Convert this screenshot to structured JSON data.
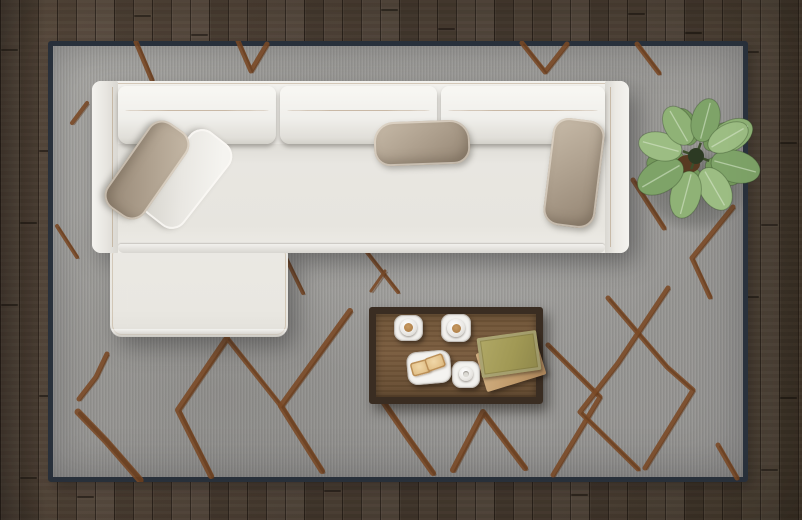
{
  "scene": {
    "description": "Top-down view of a modern living room: a white L-shaped sectional sofa with taupe and white pillows sits on a gray rug with a brown hand-drawn diamond lattice pattern; a dark wooden coffee table holds two coffee cups, a plate with toast, a small white cup and two stacked books; a leafy green potted plant stands at the top right; dark brown vertical wood planks form the floor.",
    "objects": {
      "floor": "dark wood plank floor",
      "rug": "gray area rug with brown diamond lattice pattern",
      "rug_pattern": "brown hand-drawn diamond lattice",
      "sofa": "white L-shaped sectional sofa",
      "left_arm": "sofa left armrest",
      "right_arm": "sofa right armrest",
      "back_cushion": "sofa back cushion",
      "seat": "sofa seat",
      "chaise": "chaise lounge extension",
      "pillow_taupe_corner": "taupe accent pillow (corner)",
      "pillow_white_corner": "white accent pillow (corner)",
      "pillow_taupe_center": "taupe accent pillow (center)",
      "pillow_taupe_right": "taupe accent pillow (right)",
      "table": "dark wood coffee table",
      "coffee_cup_1": "coffee cup on square saucer",
      "coffee_cup_2": "coffee cup on square saucer",
      "espresso_cup": "small white cup on square saucer",
      "toast_plate": "square plate with two toast slices",
      "book_tan": "tan book",
      "book_green": "olive green book",
      "plant": "potted green plant (top view)",
      "plant_shadow": "plant shadow on rug"
    }
  },
  "palette": {
    "floor_base": "#4c3f34",
    "floor_light": "#5b4c3e",
    "floor_dark": "#41362a",
    "rug_field": "#9e9d9a",
    "rug_border": "#2a323d",
    "rug_pattern": "#7b4a27",
    "rug_pattern_dark": "#5e3618",
    "sofa_white": "#e9e7e2",
    "pillow_taupe": "#b0a290",
    "table_wood": "#6f5437",
    "table_frame": "#3a2d22",
    "coffee": "#c79a63",
    "toast": "#e3c28b",
    "book_green": "#a19955",
    "book_tan": "#c09a6a",
    "soil": "#583a22",
    "leaf_vein": "#dcead0",
    "plant_center": "#2c3a23"
  },
  "rug": {
    "pattern_strokes": [
      {
        "w": 5,
        "pts": [
          [
            88,
            1
          ],
          [
            104,
            39
          ]
        ]
      },
      {
        "w": 5,
        "pts": [
          [
            190,
            0
          ],
          [
            203,
            30
          ],
          [
            219,
            3
          ]
        ]
      },
      {
        "w": 5,
        "pts": [
          [
            474,
            2
          ],
          [
            497,
            31
          ],
          [
            519,
            3
          ]
        ]
      },
      {
        "w": 5,
        "pts": [
          [
            589,
            3
          ],
          [
            611,
            32
          ]
        ]
      },
      {
        "w": 4,
        "pts": [
          [
            39,
            62
          ],
          [
            24,
            82
          ]
        ]
      },
      {
        "w": 4,
        "pts": [
          [
            9,
            185
          ],
          [
            29,
            216
          ]
        ]
      },
      {
        "w": 5,
        "pts": [
          [
            59,
            313
          ],
          [
            48,
            336
          ],
          [
            31,
            358
          ]
        ]
      },
      {
        "w": 7,
        "pts": [
          [
            30,
            371
          ],
          [
            58,
            400
          ],
          [
            92,
            439
          ]
        ]
      },
      {
        "w": 6,
        "pts": [
          [
            179,
            297
          ],
          [
            130,
            369
          ],
          [
            163,
            435
          ]
        ]
      },
      {
        "w": 5,
        "pts": [
          [
            179,
            297
          ],
          [
            233,
            365
          ]
        ]
      },
      {
        "w": 6,
        "pts": [
          [
            302,
            270
          ],
          [
            233,
            365
          ],
          [
            274,
            430
          ]
        ]
      },
      {
        "w": 4,
        "pts": [
          [
            237,
            215
          ],
          [
            255,
            252
          ]
        ]
      },
      {
        "w": 4,
        "pts": [
          [
            318,
            210
          ],
          [
            350,
            251
          ]
        ]
      },
      {
        "w": 3,
        "pts": [
          [
            337,
            230
          ],
          [
            323,
            250
          ]
        ]
      },
      {
        "w": 6,
        "pts": [
          [
            334,
            359
          ],
          [
            358,
            394
          ],
          [
            385,
            432
          ]
        ]
      },
      {
        "w": 6,
        "pts": [
          [
            405,
            429
          ],
          [
            435,
            371
          ],
          [
            477,
            427
          ]
        ]
      },
      {
        "w": 5,
        "pts": [
          [
            500,
            304
          ],
          [
            552,
            356
          ],
          [
            505,
            434
          ]
        ]
      },
      {
        "w": 5,
        "pts": [
          [
            560,
            257
          ],
          [
            619,
            326
          ],
          [
            645,
            349
          ],
          [
            597,
            427
          ]
        ]
      },
      {
        "w": 5,
        "pts": [
          [
            620,
            247
          ],
          [
            570,
            322
          ],
          [
            532,
            371
          ],
          [
            590,
            428
          ]
        ]
      },
      {
        "w": 5,
        "pts": [
          [
            685,
            166
          ],
          [
            644,
            217
          ],
          [
            662,
            256
          ]
        ]
      },
      {
        "w": 5,
        "pts": [
          [
            585,
            139
          ],
          [
            616,
            187
          ]
        ]
      },
      {
        "w": 5,
        "pts": [
          [
            670,
            404
          ],
          [
            689,
            437
          ]
        ]
      }
    ]
  },
  "plant": {
    "leaf_colors": [
      "#8fb276",
      "#7ea368",
      "#9cbd83",
      "#74985c"
    ],
    "under_leaves": [
      {
        "a": 30,
        "d": 12,
        "l": 38,
        "w": 24,
        "c": 3
      },
      {
        "a": 100,
        "d": 12,
        "l": 38,
        "w": 24,
        "c": 3
      },
      {
        "a": 170,
        "d": 12,
        "l": 38,
        "w": 24,
        "c": 3
      },
      {
        "a": 250,
        "d": 12,
        "l": 38,
        "w": 24,
        "c": 3
      },
      {
        "a": 320,
        "d": 12,
        "l": 36,
        "w": 22,
        "c": 3
      }
    ],
    "leaves": [
      {
        "a": -30,
        "d": 16,
        "l": 48,
        "w": 30,
        "c": 0
      },
      {
        "a": 15,
        "d": 16,
        "l": 50,
        "w": 32,
        "c": 1
      },
      {
        "a": 60,
        "d": 15,
        "l": 46,
        "w": 30,
        "c": 2
      },
      {
        "a": 105,
        "d": 16,
        "l": 48,
        "w": 30,
        "c": 0
      },
      {
        "a": 150,
        "d": 16,
        "l": 50,
        "w": 32,
        "c": 1
      },
      {
        "a": 195,
        "d": 15,
        "l": 44,
        "w": 28,
        "c": 2
      },
      {
        "a": 240,
        "d": 14,
        "l": 42,
        "w": 28,
        "c": 0
      },
      {
        "a": 285,
        "d": 15,
        "l": 44,
        "w": 28,
        "c": 1
      },
      {
        "a": 330,
        "d": 15,
        "l": 44,
        "w": 26,
        "c": 2
      }
    ]
  }
}
